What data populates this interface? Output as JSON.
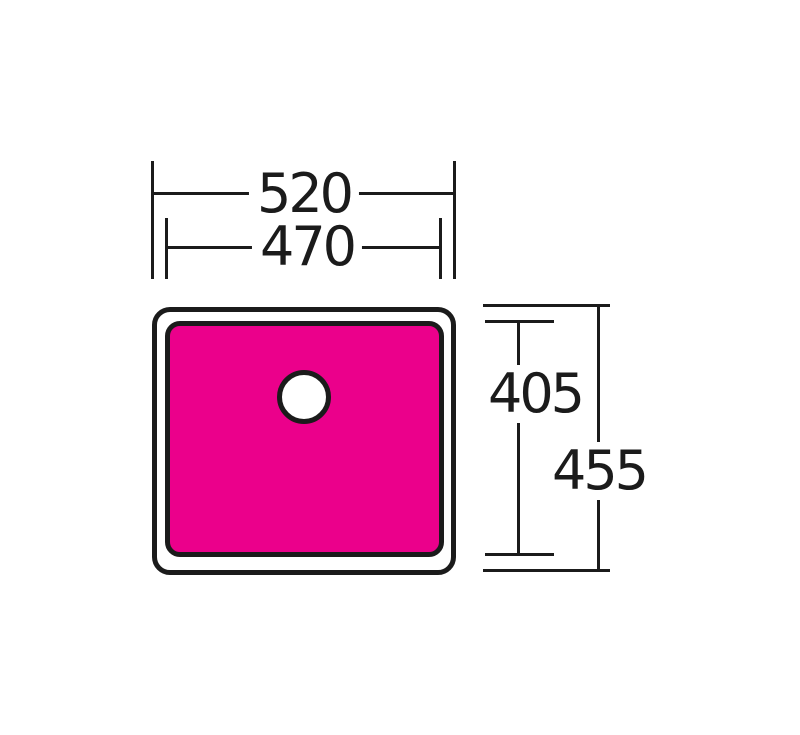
{
  "diagram": {
    "kind": "sink-top-view-dimension-drawing",
    "colors": {
      "line": "#1b1b1b",
      "sink_fill": "#eb008b",
      "background": "#ffffff"
    },
    "labels": {
      "outer_width": "520",
      "inner_width": "470",
      "inner_height": "405",
      "outer_height": "455"
    }
  }
}
